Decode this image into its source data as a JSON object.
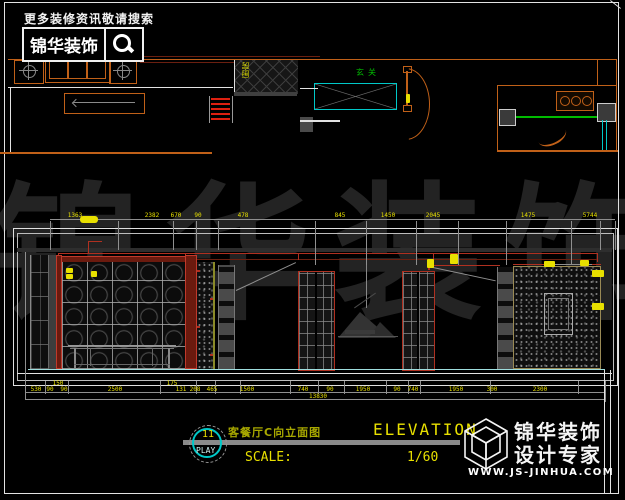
{
  "header": {
    "search_hint": "更多装修资讯敬请搜索",
    "brand": "锦华装饰",
    "search_icon": "magnifier-icon"
  },
  "plan_labels": {
    "kitchen": "厨房",
    "entry": "玄关"
  },
  "watermark": "锦华装饰",
  "elevation": {
    "dims_top": [
      "1363",
      "2382",
      "670",
      "90",
      "478",
      "845",
      "1450",
      "2045",
      "1475",
      "5744"
    ],
    "dims_bottom": [
      "530",
      "90",
      "150",
      "90",
      "2500",
      "175",
      "131",
      "208",
      "465",
      "1500",
      "740",
      "90",
      "1950",
      "90",
      "740",
      "1950",
      "300",
      "2300"
    ],
    "total_dim": "13830"
  },
  "title_block": {
    "bubble_number": "11",
    "bubble_label": "PLAY",
    "title_cn": "客餐厅C向立面图",
    "title_en": "ELEVATION",
    "scale_label": "SCALE:",
    "scale_value": "1/60"
  },
  "brand_footer": {
    "name": "锦华装饰",
    "tagline": "设计专家",
    "website": "WWW.JS-JINHUA.COM",
    "logo": "cube-logo"
  },
  "colors": {
    "accent_orange": "#c06018",
    "cad_red": "#b03020",
    "cad_yellow": "#e8e000",
    "cad_cyan": "#00c8c8",
    "cad_green": "#00bb00",
    "floor_cyan": "#9fdede",
    "watermark_gray": "#232323"
  }
}
